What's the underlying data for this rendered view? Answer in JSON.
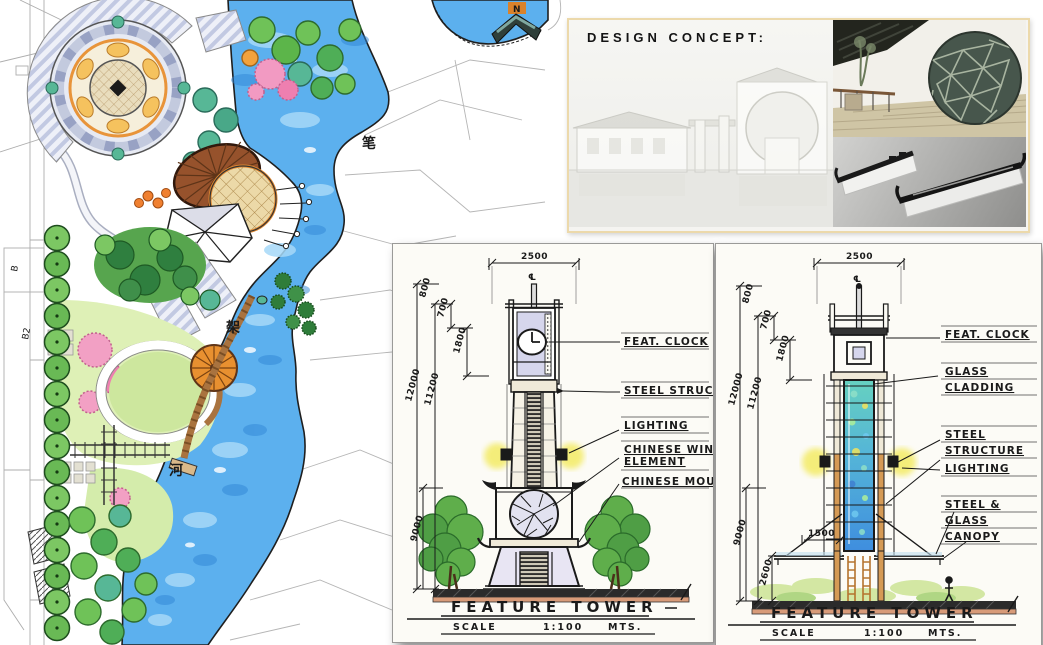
{
  "concept": {
    "title": "DESIGN CONCEPT:"
  },
  "map": {
    "river_chars": [
      "笔",
      "架",
      "河"
    ],
    "plot_label_b": "B",
    "plot_label_b2": "B2",
    "north_label": "N"
  },
  "towers": {
    "left": {
      "title": "FEATURE TOWER",
      "scale_word": "SCALE",
      "scale_value": "1:100",
      "units_word": "MTS.",
      "centerline": "℄",
      "dims": {
        "width": "2500",
        "top": "800",
        "upper": "700",
        "clock": "1800",
        "total": "12000",
        "shaft": "11200",
        "lower": "9000"
      },
      "annotations": {
        "feat_clock": "FEAT. CLOCK",
        "steel_struct": "STEEL STRUCT.",
        "lighting": "LIGHTING",
        "window_line1": "CHINESE WINDOW",
        "window_line2": "ELEMENT",
        "moulding": "CHINESE MOULDING"
      }
    },
    "right": {
      "title": "FEATURE TOWER",
      "scale_word": "SCALE",
      "scale_value": "1:100",
      "units_word": "MTS.",
      "centerline": "℄",
      "dims": {
        "width": "2500",
        "top": "800",
        "upper": "700",
        "clock": "1800",
        "total": "12000",
        "shaft": "11200",
        "lower": "9000",
        "canopy": "1500",
        "base": "2600"
      },
      "annotations": {
        "feat_clock": "FEAT. CLOCK",
        "glass_line1": "GLASS",
        "glass_line2": "CLADDING",
        "steel_line1": "STEEL",
        "steel_line2": "STRUCTURE",
        "lighting": "LIGHTING",
        "canopy_line1": "STEEL &",
        "canopy_line2": "GLASS",
        "canopy_line3": "CANOPY"
      }
    }
  }
}
